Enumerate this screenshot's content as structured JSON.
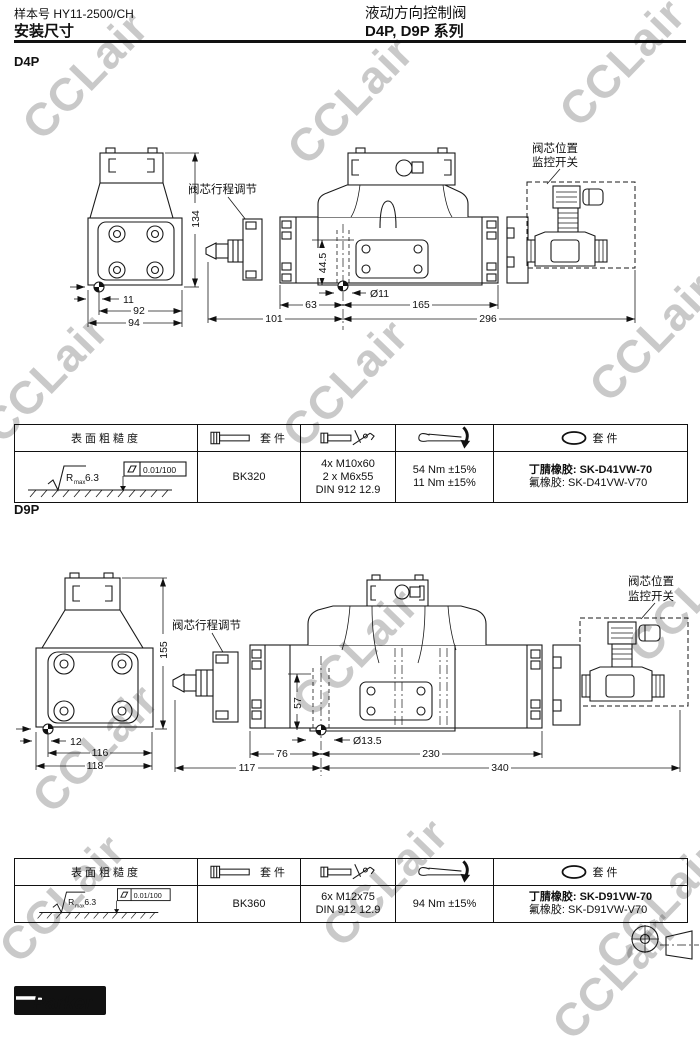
{
  "header": {
    "catalog": "样本号 HY11-2500/CH",
    "title": "安装尺寸",
    "product": "液动方向控制阀",
    "series": "D4P, D9P 系列"
  },
  "watermark": {
    "text": "CCLair",
    "color": "#c9c9c9"
  },
  "d4p": {
    "label": "D4P",
    "adjust_label": "阀芯行程调节",
    "switch_line1": "阀芯位置",
    "switch_line2": "监控开关",
    "dims": {
      "height": "134",
      "edge": "11",
      "w1": "92",
      "w2": "94",
      "pad": "44.5",
      "hole": "Ø11",
      "a": "63",
      "b": "101",
      "c": "165",
      "d": "296"
    }
  },
  "d9p": {
    "label": "D9P",
    "adjust_label": "阀芯行程调节",
    "switch_line1": "阀芯位置",
    "switch_line2": "监控开关",
    "dims": {
      "height": "155",
      "edge": "12",
      "w1": "116",
      "w2": "118",
      "pad": "57",
      "hole": "Ø13.5",
      "a": "76",
      "b": "117",
      "c": "230",
      "d": "340"
    }
  },
  "tables": {
    "header_roughness": "表面粗糙度",
    "header_kit": "套件",
    "roughness": {
      "r": "R",
      "sub": "max",
      "value": "6.3",
      "flatness": "0.01/100"
    },
    "d4p": {
      "kit": "BK320",
      "bolts": [
        "4x M10x60",
        "2 x M6x55",
        "DIN 912 12.9"
      ],
      "torque": [
        "54 Nm ±15%",
        "11 Nm ±15%"
      ],
      "seal1_label": "丁腈橡胶:",
      "seal1": "SK-D41VW-70",
      "seal2_label": "氟橡胶:",
      "seal2": "SK-D41VW-V70"
    },
    "d9p": {
      "kit": "BK360",
      "bolts": [
        "6x M12x75",
        "DIN 912 12.9"
      ],
      "torque": [
        "94 Nm ±15%"
      ],
      "seal1_label": "丁腈橡胶:",
      "seal1": "SK-D91VW-70",
      "seal2_label": "氟橡胶:",
      "seal2": "SK-D91VW-V70"
    }
  },
  "footer": {
    "brand": "Parker"
  }
}
